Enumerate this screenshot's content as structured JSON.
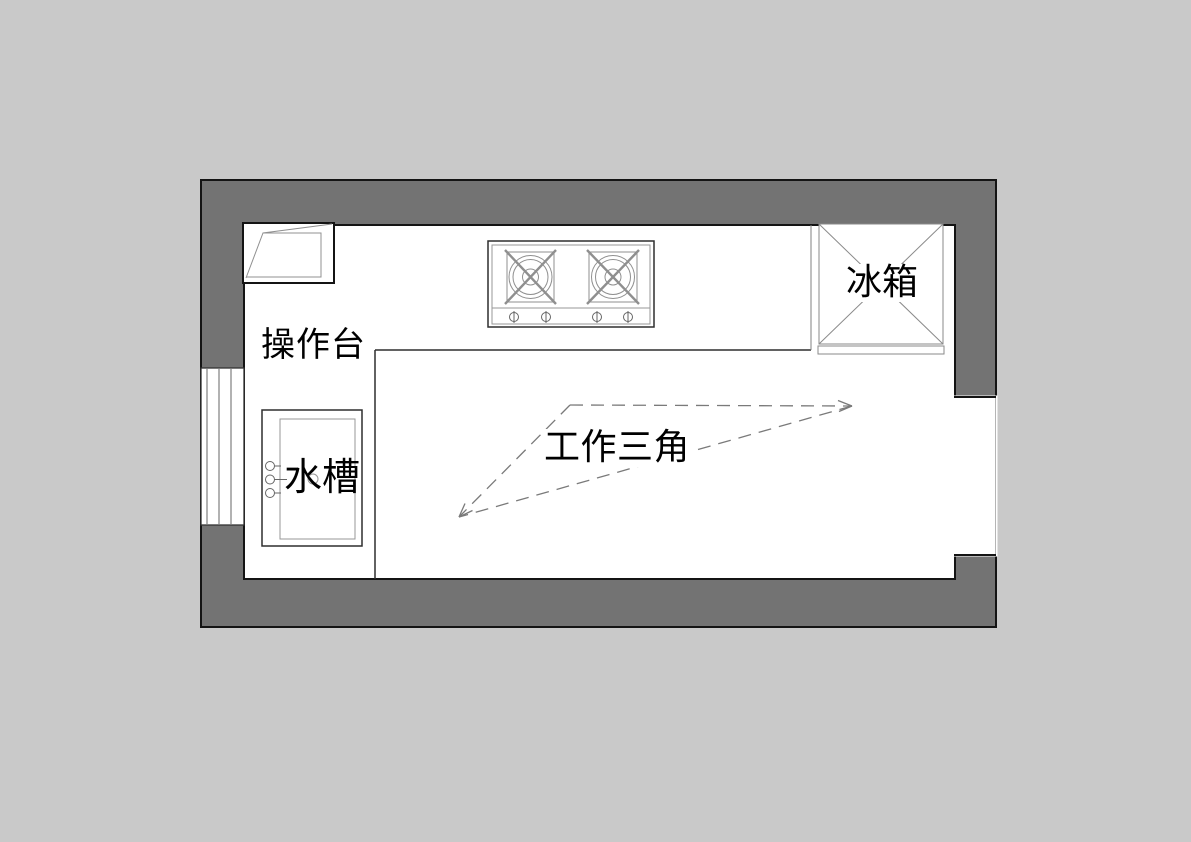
{
  "diagram": {
    "type": "kitchen-floor-plan",
    "labels": {
      "countertop": "操作台",
      "sink": "水槽",
      "refrigerator": "冰箱",
      "work_triangle": "工作三角"
    },
    "fixtures": [
      "corner-cabinet",
      "countertop",
      "stove-two-burners",
      "refrigerator",
      "sink-with-faucet",
      "window-left-wall",
      "opening-right-wall"
    ],
    "work_triangle": {
      "style": "dashed",
      "connects": [
        "stove",
        "refrigerator",
        "sink"
      ],
      "vertices_px": [
        [
          570,
          405
        ],
        [
          852,
          406
        ],
        [
          459,
          517
        ]
      ]
    },
    "colors": {
      "background": "#c9c9c9",
      "wall_fill": "#737373",
      "wall_outline": "#141414",
      "room_fill": "#ffffff",
      "fixture_outline_dark": "#2e2e2e",
      "fixture_line_light": "#8f8f8f",
      "dashed_line": "#7a7a7a",
      "text": "#000000"
    }
  }
}
